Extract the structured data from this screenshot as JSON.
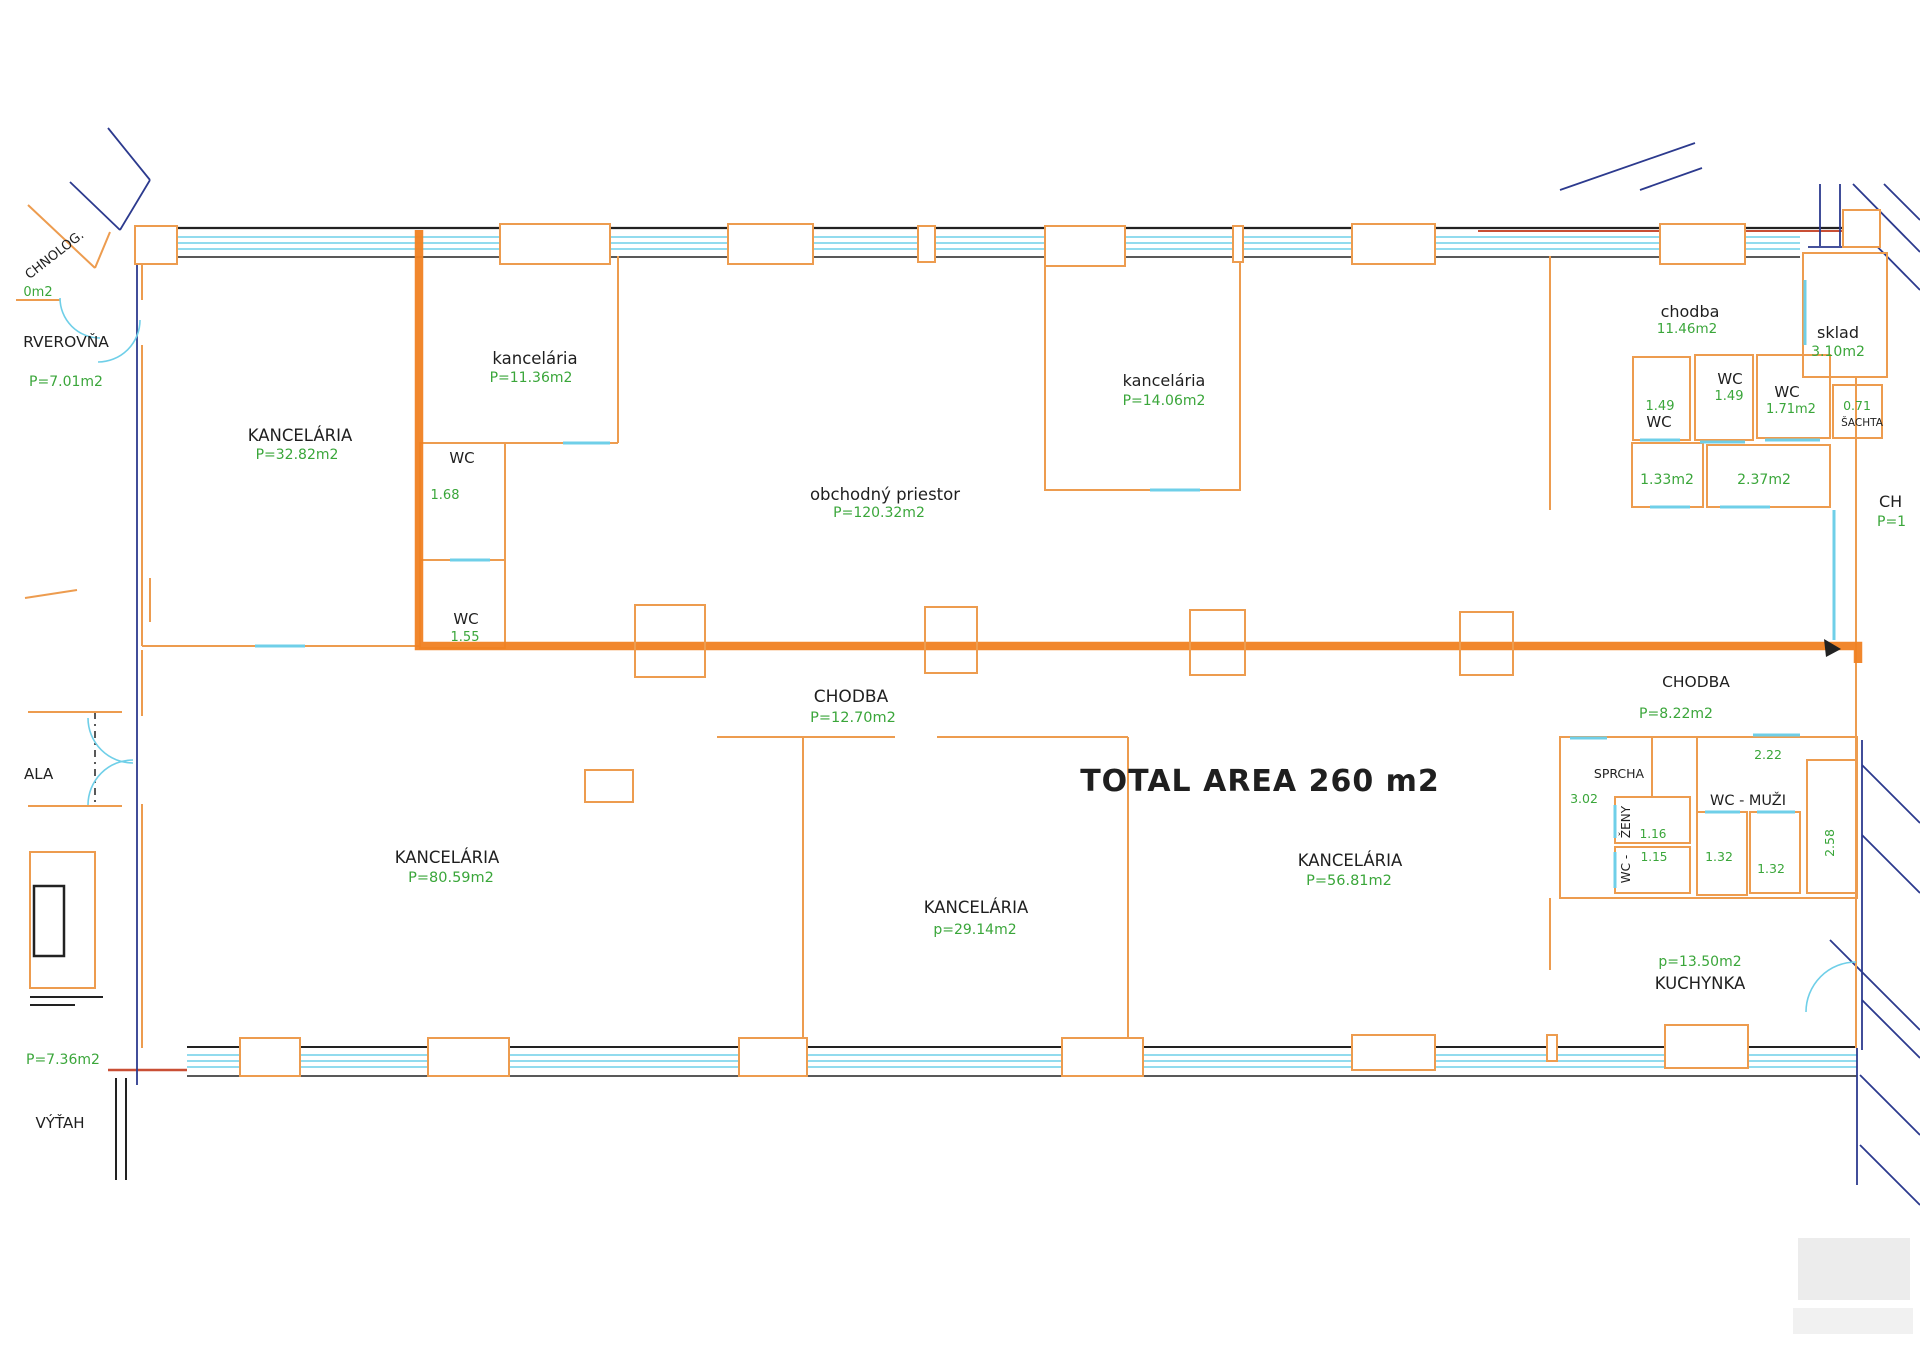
{
  "document": {
    "type": "floor-plan",
    "total_area_label": "TOTAL AREA 260 m2"
  },
  "colors": {
    "wall": "#ED9C4F",
    "window": "#6FCFE8",
    "outline_blue": "#2c3a8e",
    "highlight_route": "#F08122",
    "area_text_green": "#3AA63A",
    "room_text_black": "#1F1F1F",
    "red_wall": "#C94F35"
  },
  "rooms": {
    "technolog": {
      "name": "CHNOLOG.",
      "area": "0m2"
    },
    "serverovna": {
      "name": "RVEROVŇA",
      "area": "P=7.01m2"
    },
    "kancelaria_32": {
      "name": "KANCELÁRIA",
      "area": "P=32.82m2"
    },
    "kancelaria_11": {
      "name": "kancelária",
      "area": "P=11.36m2"
    },
    "wc_168": {
      "name": "WC",
      "area": "1.68"
    },
    "wc_155": {
      "name": "WC",
      "area": "1.55"
    },
    "obchodny_priestor": {
      "name": "obchodný priestor",
      "area": "P=120.32m2"
    },
    "kancelaria_14": {
      "name": "kancelária",
      "area": "P=14.06m2"
    },
    "chodba_horna": {
      "name": "chodba",
      "area": "11.46m2"
    },
    "sklad": {
      "name": "sklad",
      "area": "3.10m2"
    },
    "wc_149a": {
      "name": "WC",
      "area": "1.49"
    },
    "wc_149b": {
      "name": "WC",
      "area": "1.49"
    },
    "wc_171": {
      "name": "WC",
      "area": "1.71m2"
    },
    "sachta": {
      "name": "ŠACHTA",
      "area": "0.71"
    },
    "kabinka_133": {
      "area": "1.33m2"
    },
    "kabinka_237": {
      "area": "2.37m2"
    },
    "chodba_cut": {
      "name": "CH",
      "area": "P=1"
    },
    "chodba_stred": {
      "name": "CHODBA",
      "area": "P=12.70m2"
    },
    "chodba_prava": {
      "name": "CHODBA",
      "area": "P=8.22m2"
    },
    "kancelaria_80": {
      "name": "KANCELÁRIA",
      "area": "P=80.59m2"
    },
    "kancelaria_29": {
      "name": "KANCELÁRIA",
      "area": "p=29.14m2"
    },
    "kancelaria_56": {
      "name": "KANCELÁRIA",
      "area": "P=56.81m2"
    },
    "sprcha": {
      "name": "SPRCHA",
      "area": "3.02"
    },
    "zeny": {
      "name": "ŽENY",
      "area": "1.16"
    },
    "wc_zeny": {
      "name": "WC -",
      "area": "1.15"
    },
    "muzi_predsien": {
      "area": "2.22"
    },
    "wc_muzi": {
      "name": "WC - MUŽI"
    },
    "kabinka_132a": {
      "area": "1.32"
    },
    "kabinka_132b": {
      "area": "1.32"
    },
    "kabinka_258": {
      "area": "2.58"
    },
    "kuchynka": {
      "name": "KUCHYNKA",
      "area": "p=13.50m2"
    },
    "vytah": {
      "name": "VÝŤAH",
      "area": "P=7.36m2"
    },
    "sala": {
      "name": "ALA"
    }
  }
}
